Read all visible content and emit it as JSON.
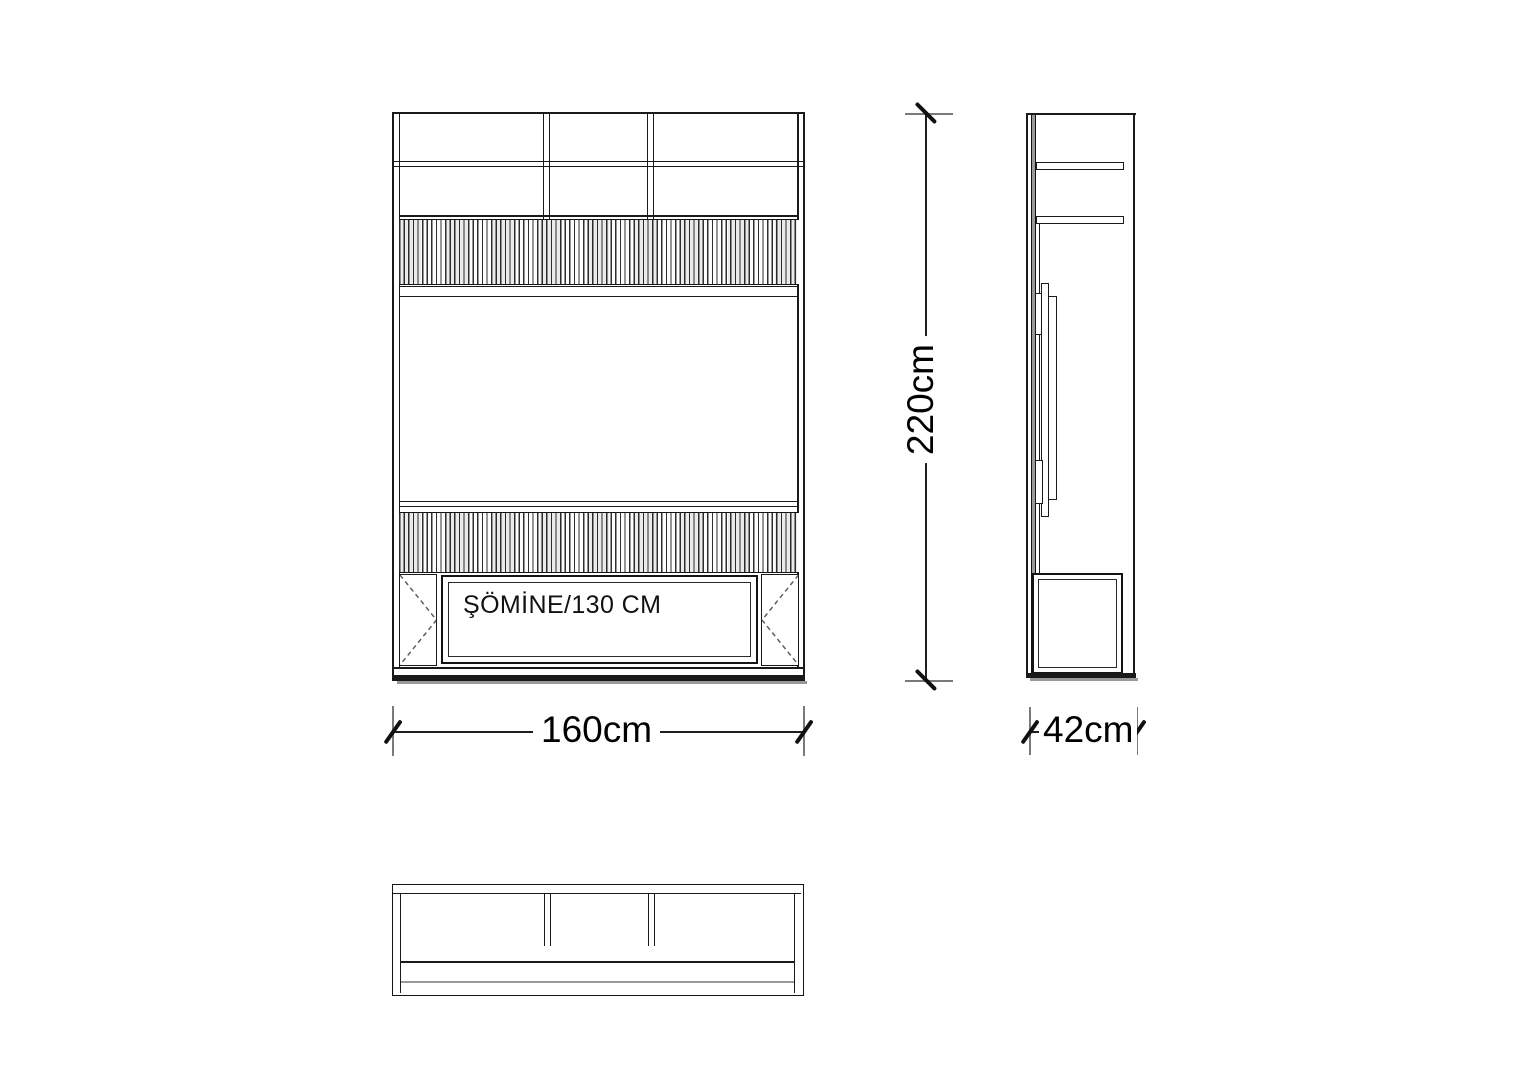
{
  "drawing": {
    "labels": {
      "fireplace": "ŞÖMİNE/130 CM"
    },
    "dimensions": {
      "height": "220cm",
      "width": "160cm",
      "depth": "42cm"
    },
    "colors": {
      "line": "#1a1a1a",
      "shadow": "#999999",
      "background": "#ffffff"
    }
  }
}
